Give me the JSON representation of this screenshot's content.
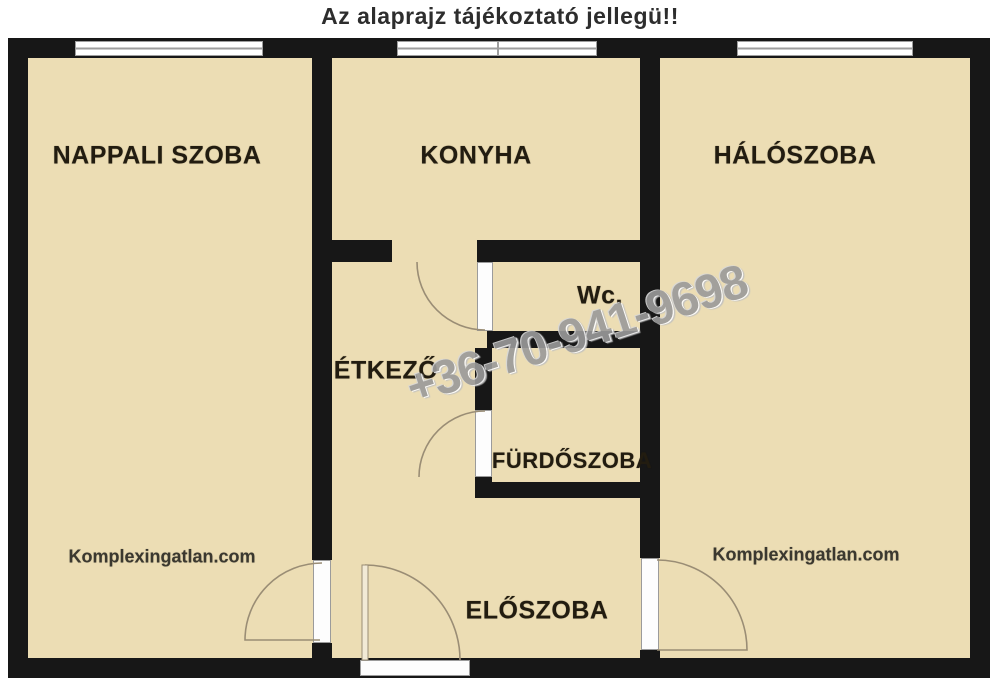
{
  "title": "Az alaprajz tájékoztató jellegü!!",
  "rooms": {
    "nappali": {
      "label": "NAPPALI SZOBA"
    },
    "konyha": {
      "label": "KONYHA"
    },
    "halo": {
      "label": "HÁLÓSZOBA"
    },
    "wc": {
      "label": "Wc."
    },
    "etkezo": {
      "label": "ÉTKEZŐ"
    },
    "furdo": {
      "label": "FÜRDŐSZOBA"
    },
    "eloszoba": {
      "label": "ELŐSZOBA"
    }
  },
  "watermark": {
    "phone": "+36-70-941-9698",
    "site_left": "Komplexingatlan.com",
    "site_right": "Komplexingatlan.com"
  },
  "colors": {
    "room": "#ecddb4",
    "wall": "#171717",
    "paper": "#ffffff",
    "ink": "#221c10",
    "watermark": "#9a9a9a",
    "arc": "#9a8d75",
    "frame": "#9e9e9e"
  }
}
